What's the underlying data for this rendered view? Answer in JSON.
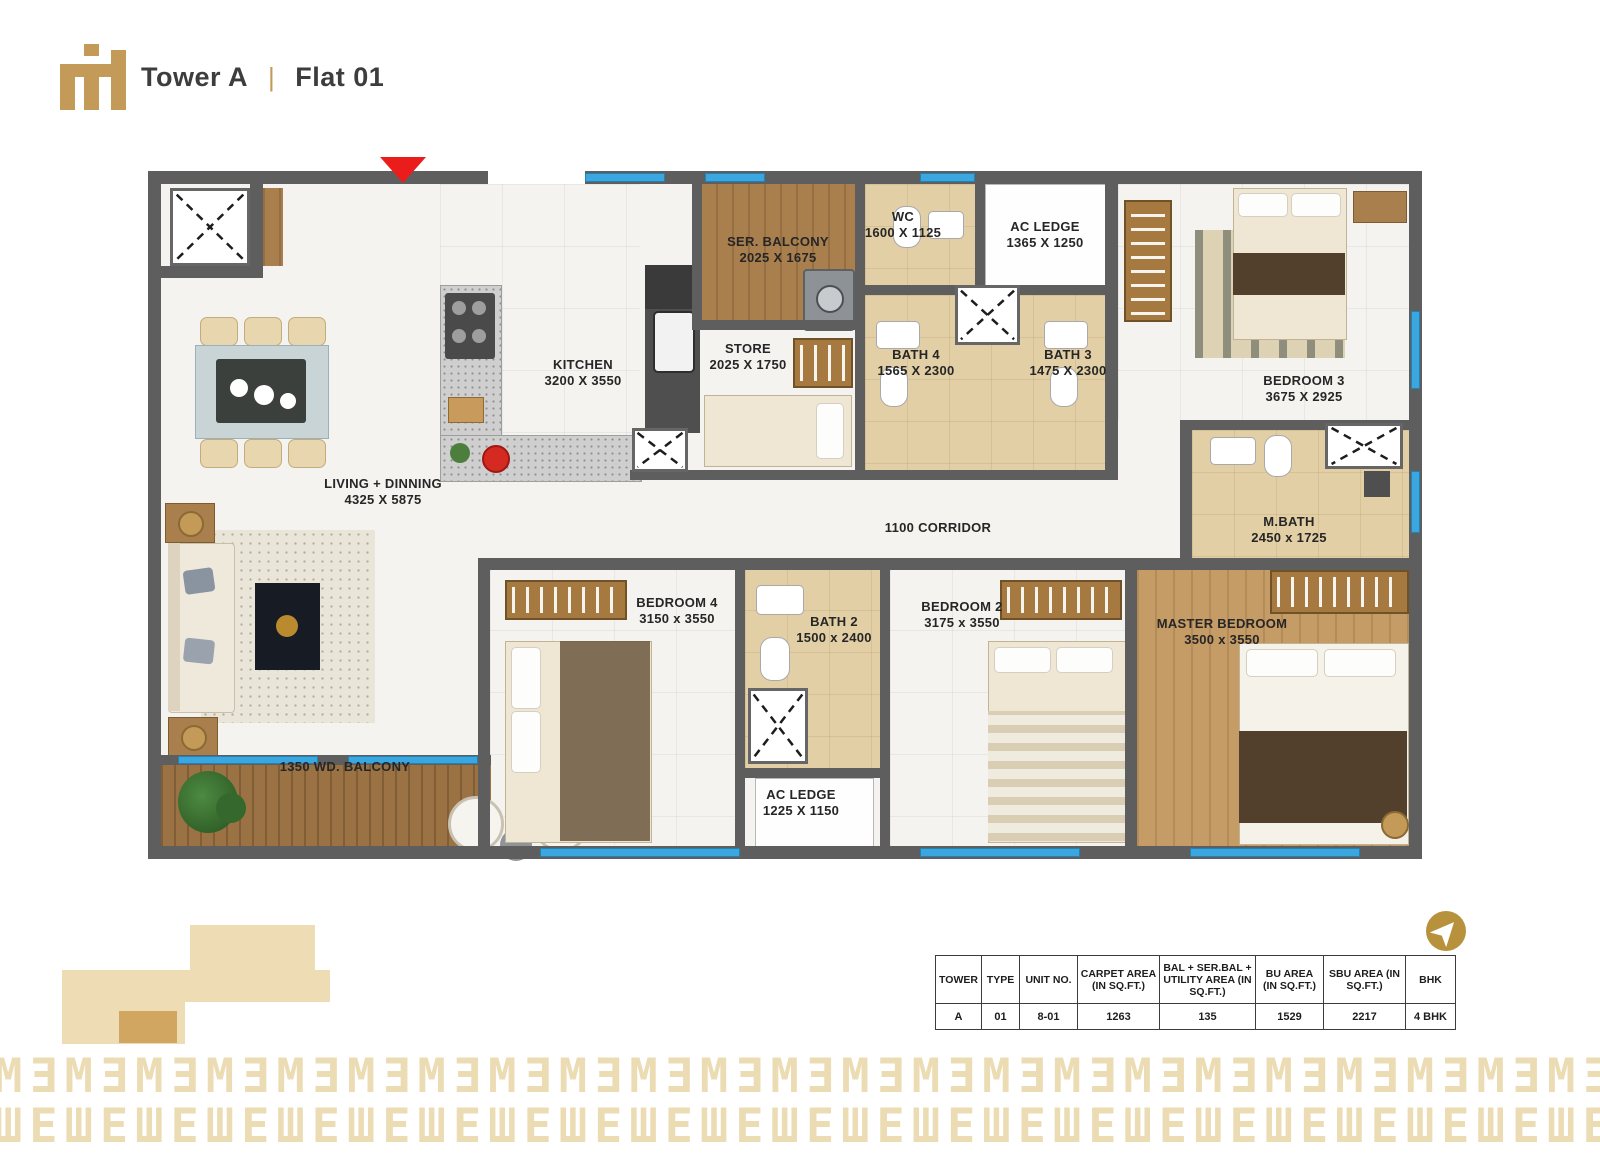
{
  "header": {
    "tower": "Tower A",
    "divider": "|",
    "flat": "Flat 01"
  },
  "plan": {
    "rooms": [
      {
        "name": "SER. BALCONY",
        "dims": "2025 X 1675"
      },
      {
        "name": "WC",
        "dims": "1600 X 1125"
      },
      {
        "name": "AC LEDGE",
        "dims": "1365 X 1250"
      },
      {
        "name": "KITCHEN",
        "dims": "3200 X 3550"
      },
      {
        "name": "STORE",
        "dims": "2025 X 1750"
      },
      {
        "name": "BATH 4",
        "dims": "1565 X 2300"
      },
      {
        "name": "BATH 3",
        "dims": "1475 X 2300"
      },
      {
        "name": "BEDROOM 3",
        "dims": "3675 X 2925"
      },
      {
        "name": "LIVING + DINNING",
        "dims": "4325 X 5875"
      },
      {
        "name": "M.BATH",
        "dims": "2450 x 1725"
      },
      {
        "name": "BEDROOM 4",
        "dims": "3150 x 3550"
      },
      {
        "name": "BATH 2",
        "dims": "1500 x 2400"
      },
      {
        "name": "BEDROOM 2",
        "dims": "3175 x 3550"
      },
      {
        "name": "MASTER BEDROOM",
        "dims": "3500 x 3550"
      },
      {
        "name": "AC LEDGE",
        "dims": "1225 X 1150"
      }
    ],
    "corridor_label": "1100  CORRIDOR",
    "balcony_label": "1350 WD. BALCONY"
  },
  "table": {
    "headers": [
      "TOWER",
      "TYPE",
      "UNIT  NO.",
      "CARPET AREA (IN  SQ.FT.)",
      "BAL + SER.BAL + UTILITY AREA (IN  SQ.FT.)",
      "BU AREA (IN  SQ.FT.)",
      "SBU AREA (IN  SQ.FT.)",
      "BHK"
    ],
    "row": [
      "A",
      "01",
      "8-01",
      "1263",
      "135",
      "1529",
      "2217",
      "4 BHK"
    ]
  },
  "pattern": {
    "row1_unit": "MƎ",
    "row2_unit": "ШE",
    "repeat": 26
  },
  "colors": {
    "accent_gold": "#c49a58",
    "wall_gray": "#5e5e5e",
    "window_blue": "#3aa7e0",
    "entrance_red": "#ea1c1c",
    "pattern_tan": "#ecdcb4",
    "bath_tan": "#e3cfa5",
    "wood": "#a97f4e"
  }
}
